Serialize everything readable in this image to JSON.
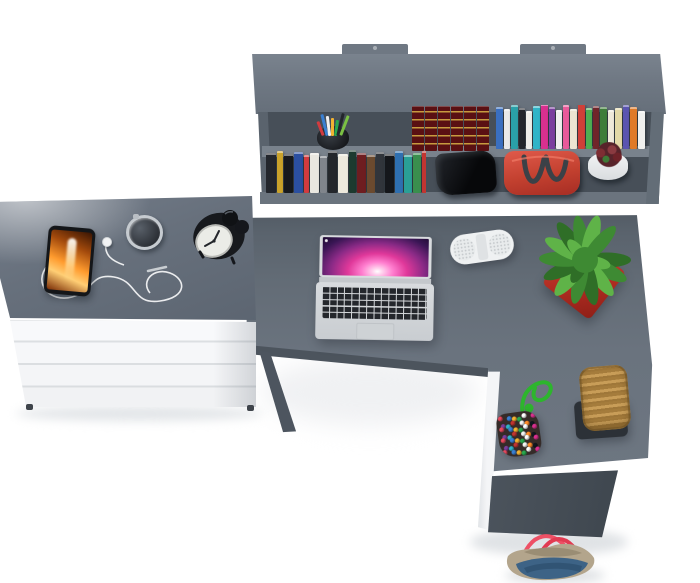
{
  "scene": {
    "type": "3d-furniture-product-render-top-view",
    "background": "#ffffff",
    "furniture": {
      "wall_shelf": {
        "color": "#6f7883",
        "interior_color": "#474f58",
        "mounting_tabs": 2,
        "shelf_levels": 2
      },
      "dresser": {
        "top_color": "#67707c",
        "front_color": "#f5f6f8",
        "drawer_count": 4
      },
      "desk": {
        "shape": "L-shaped",
        "top_color": "#636c77",
        "edge_color": "#4c545d",
        "support_color": "#f4f5f7"
      }
    }
  },
  "palette": {
    "surface": "#636c77",
    "surface-dark": "#4c545d",
    "panel": "#6f7883",
    "interior": "#474f58",
    "lip": "#79828c",
    "white-furn": "#f5f6f8",
    "speaker": "#eff1f2",
    "pot-red": "#c0392e",
    "leaf-dark": "#2f6e27",
    "leaf-mid": "#3e8a33",
    "leaf-light": "#5fb348",
    "phone-frame": "#141619",
    "cable": "#f2f3f4",
    "clock-body": "#17191d",
    "clock-face": "#ebece7",
    "cup": "#22262b",
    "bag-red": "#d0463c",
    "bag-handle": "#3c4147",
    "flower-pot": "#edeff1",
    "bloom": "#7e2d33",
    "black-box": "#0e1013",
    "cord-green": "#2db52d",
    "pouch-base": "#352b28",
    "stool-tan": "#c89d58",
    "stool-tan2": "#a57c3c",
    "stool-base": "#2c3137",
    "denim": "#3d6386",
    "denim-dark": "#2e4f6e",
    "trim": "#b3a58c",
    "handle-pink": "#ee5065",
    "enc-spine": "#5a1013",
    "enc-gold": "#c79b3f"
  },
  "objects": {
    "laptop": {
      "kind": "silver laptop, open, top view",
      "body": "#d6d9dc",
      "keys": "#24272c",
      "screen_colors": [
        "#ffffff",
        "#ff7ecf",
        "#e0389a",
        "#8a2a86",
        "#2a1040"
      ]
    },
    "speaker": {
      "kind": "white pill bluetooth speaker",
      "color": "#eff1f2"
    },
    "plant": {
      "kind": "green succulent in red square pot",
      "pot": "#c0392e",
      "leaf_colors": [
        "#2f6e27",
        "#3e8a33",
        "#5fb348"
      ]
    },
    "smartphone": {
      "kind": "phone with orange flame wallpaper",
      "frame": "#141619",
      "screen_colors": [
        "#ffd27a",
        "#ff9b2e",
        "#c2590e",
        "#6b2a07"
      ]
    },
    "earphones": {
      "kind": "white wired earbuds, tangled cable",
      "cable": "#f2f3f4"
    },
    "watch": {
      "kind": "round silver watch",
      "case": "#c6cbd0",
      "face": "#33373d"
    },
    "alarm_clock": {
      "kind": "black twin-bell alarm clock",
      "body": "#17191d",
      "face": "#ebece7"
    },
    "pen_cup": {
      "cup": "#22262b",
      "pen_colors": [
        "#d23b3f",
        "#3a7fd2",
        "#f0f0f0",
        "#f2b332",
        "#2aa84f",
        "#23262b",
        "#7ac043"
      ]
    },
    "handbag": {
      "kind": "red handbag on shelf",
      "body": "#d0463c",
      "handles": "#3c4147"
    },
    "flower_pot": {
      "kind": "white pot with dark red succulent",
      "pot": "#edeff1",
      "bloom_colors": [
        "#7e2d33",
        "#8a3a40",
        "#6e2228",
        "#3f7a37"
      ]
    },
    "black_box": {
      "kind": "black glossy object on shelf",
      "color": "#0e1013"
    },
    "bead_pouch": {
      "kind": "multicolor bead pouch with green cord",
      "cord": "#2db52d",
      "base": "#352b28",
      "bead_colors": [
        "#e84a5f",
        "#3a7fd2",
        "#f2b332",
        "#2aa84f",
        "#ffffff",
        "#d9308f",
        "#7a3f9e",
        "#30b4c8",
        "#c23531",
        "#f5f5f5",
        "#ff8c2a",
        "#111820"
      ]
    },
    "wicker_stool": {
      "kind": "woven rattan stool on dark base",
      "seat": "#c89d58",
      "base": "#2c3137"
    },
    "tote_bag": {
      "kind": "denim tote bag with pink rope handles",
      "body": "#3d6386",
      "trim": "#b3a58c",
      "handles": "#ee5065"
    }
  },
  "books": {
    "encyclopedia_set": {
      "volumes": 6,
      "spine": "#5a1013",
      "ornament": "#c79b3f"
    },
    "upper_row": [
      {
        "c": "#3a6fc0",
        "w": 7,
        "h": 40
      },
      {
        "c": "#e9e9e9",
        "w": 6,
        "h": 38
      },
      {
        "c": "#2aa0a8",
        "w": 7,
        "h": 42
      },
      {
        "c": "#23262c",
        "w": 6,
        "h": 39
      },
      {
        "c": "#efeeea",
        "w": 6,
        "h": 36
      },
      {
        "c": "#30b4c8",
        "w": 7,
        "h": 41
      },
      {
        "c": "#d9308f",
        "w": 7,
        "h": 43
      },
      {
        "c": "#7a3f9e",
        "w": 6,
        "h": 40
      },
      {
        "c": "#f0f0ee",
        "w": 6,
        "h": 37
      },
      {
        "c": "#e85a9a",
        "w": 6,
        "h": 42
      },
      {
        "c": "#ece5d2",
        "w": 7,
        "h": 38
      },
      {
        "c": "#d04038",
        "w": 7,
        "h": 44
      },
      {
        "c": "#4fae52",
        "w": 6,
        "h": 39
      },
      {
        "c": "#70252a",
        "w": 6,
        "h": 41
      },
      {
        "c": "#3f7d3a",
        "w": 7,
        "h": 40
      },
      {
        "c": "#efe9da",
        "w": 6,
        "h": 37
      },
      {
        "c": "#e3d9a8",
        "w": 7,
        "h": 39
      },
      {
        "c": "#5a55b0",
        "w": 6,
        "h": 42
      },
      {
        "c": "#e07a28",
        "w": 7,
        "h": 40
      },
      {
        "c": "#f0f0ee",
        "w": 7,
        "h": 36
      }
    ],
    "lower_row": [
      {
        "c": "#23262c",
        "w": 10,
        "h": 38
      },
      {
        "c": "#caa22a",
        "w": 6,
        "h": 40
      },
      {
        "c": "#17191d",
        "w": 9,
        "h": 37
      },
      {
        "c": "#2b4fa0",
        "w": 9,
        "h": 39
      },
      {
        "c": "#d23b3f",
        "w": 5,
        "h": 36
      },
      {
        "c": "#e9e7e0",
        "w": 9,
        "h": 38
      },
      {
        "c": "#80858c",
        "w": 7,
        "h": 35
      },
      {
        "c": "#24272c",
        "w": 9,
        "h": 40
      },
      {
        "c": "#ede9dd",
        "w": 10,
        "h": 37
      },
      {
        "c": "#1d3a2f",
        "w": 7,
        "h": 41
      },
      {
        "c": "#6e1d20",
        "w": 9,
        "h": 38
      },
      {
        "c": "#6b4a2f",
        "w": 8,
        "h": 36
      },
      {
        "c": "#31353b",
        "w": 8,
        "h": 39
      },
      {
        "c": "#15171b",
        "w": 9,
        "h": 37
      },
      {
        "c": "#2e6fb0",
        "w": 8,
        "h": 40
      },
      {
        "c": "#2a9f96",
        "w": 8,
        "h": 36
      },
      {
        "c": "#3a8f4e",
        "w": 8,
        "h": 38
      },
      {
        "c": "#c23531",
        "w": 9,
        "h": 40
      }
    ]
  }
}
